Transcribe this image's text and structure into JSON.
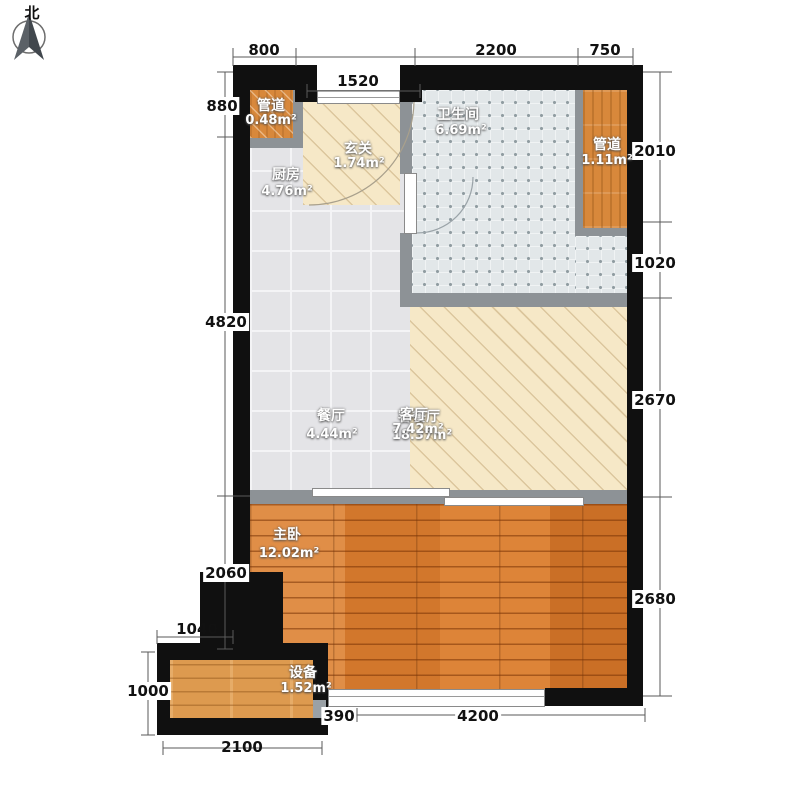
{
  "compass": {
    "north_label": "北"
  },
  "rooms": {
    "duct_left": {
      "name": "管道",
      "area": "0.48m²"
    },
    "entry": {
      "name": "玄关",
      "area": "1.74m²"
    },
    "kitchen": {
      "name": "厨房",
      "area": "4.76m²"
    },
    "bathroom": {
      "name": "卫生间",
      "area": "6.69m²"
    },
    "duct_right": {
      "name": "管道",
      "area": "1.11m²"
    },
    "dining": {
      "name": "餐厅",
      "area": "4.44m²"
    },
    "living": {
      "name": "客厅",
      "area": "7.42m²"
    },
    "living_dining": {
      "name": "客餐厅",
      "area": "18.37m²"
    },
    "master_bedroom": {
      "name": "主卧",
      "area": "12.02m²"
    },
    "equipment": {
      "name": "设备",
      "area": "1.52m²"
    }
  },
  "dimensions_mm": {
    "top": {
      "seg1": "800",
      "seg2": "2200",
      "seg3": "750",
      "entry_opening": "1520"
    },
    "left": {
      "seg1": "880",
      "seg2": "4820",
      "seg3": "2060"
    },
    "right": {
      "seg1": "2010",
      "seg2": "1020",
      "seg3": "2670",
      "seg4": "2680"
    },
    "bottom": {
      "seg1": "390",
      "seg2": "4200",
      "ext_width": "2100",
      "ext_offset": "1040",
      "ext_height": "1000"
    }
  },
  "colors": {
    "wall": "#101010",
    "partition": "#8d9296",
    "tile-floor": "#e4e4e7",
    "cream-floor": "#f6e8c7",
    "bath-floor": "#e2e7e9",
    "duct-wood": "#d8883b",
    "bedroom-wood": "#d97f35",
    "equip-wood": "#dd9a4f",
    "label-text": "#ffffff",
    "dim-text": "#111111"
  }
}
